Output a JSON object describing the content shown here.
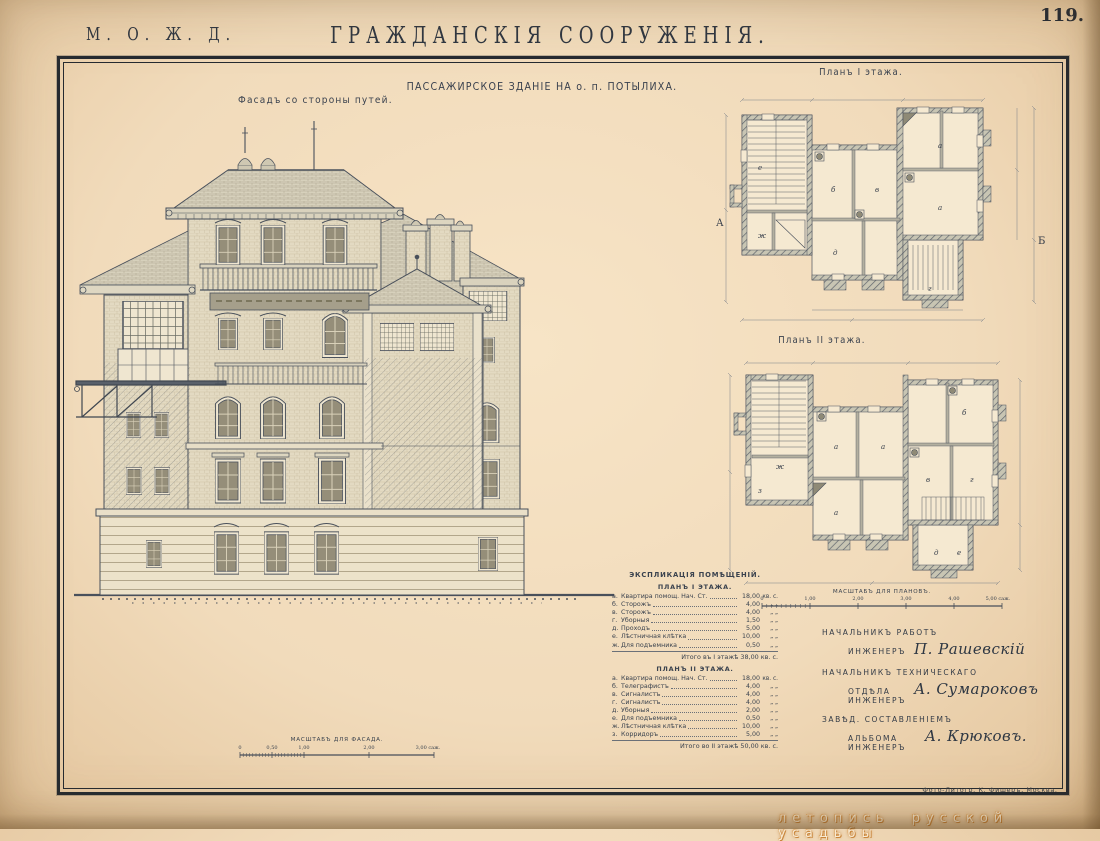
{
  "page": {
    "org": "М. О. Ж. Д.",
    "title": "ГРАЖДАНСКІЯ СООРУЖЕНІЯ.",
    "number": "119.",
    "credit": "Фото-Литогр. К. Фишеръ, Москва.",
    "watermark": "летопись русской усадьбы"
  },
  "plate": {
    "caption": "ПАССАЖИРСКОЕ ЗДАНІЕ НА о. п. ПОТЫЛИХА.",
    "facade_label": "Фасадъ со стороны путей.",
    "plan1_label": "Планъ I этажа.",
    "plan2_label": "Планъ II этажа.",
    "facade_scale": {
      "label": "МАСШТАБЪ ДЛЯ ФАСАДА.",
      "ticks": [
        "0",
        "0,50",
        "1,00",
        "2,00",
        "3,00 саж."
      ]
    },
    "plans_scale": {
      "label": "МАСШТАБЪ ДЛЯ ПЛАНОВЪ.",
      "ticks": [
        "0",
        "1,00",
        "2,00",
        "3,00",
        "4,00",
        "5,00 саж."
      ]
    }
  },
  "plan1": {
    "rooms": [
      "а",
      "б",
      "в",
      "г",
      "д",
      "е",
      "ж"
    ],
    "markers": {
      "left": "А",
      "right": "Б"
    }
  },
  "plan2": {
    "rooms": [
      "а",
      "б",
      "в",
      "г",
      "д",
      "е",
      "ж",
      "з"
    ]
  },
  "explication": {
    "header": "ЭКСПЛИКАЦІЯ ПОМѢЩЕНІЙ.",
    "floor1": {
      "title": "ПЛАНЪ I ЭТАЖА.",
      "items": [
        {
          "letter": "а.",
          "name": "Квартира помощ. Нач. Ст.",
          "value": "18,00",
          "unit": "кв. с."
        },
        {
          "letter": "б.",
          "name": "Сторожъ",
          "value": "4,00",
          "unit": "„ „"
        },
        {
          "letter": "в.",
          "name": "Сторожъ",
          "value": "4,00",
          "unit": "„ „"
        },
        {
          "letter": "г.",
          "name": "Уборныя",
          "value": "1,50",
          "unit": "„ „"
        },
        {
          "letter": "д.",
          "name": "Проходъ",
          "value": "5,00",
          "unit": "„ „"
        },
        {
          "letter": "е.",
          "name": "Лѣстничная клѣтка",
          "value": "10,00",
          "unit": "„ „"
        },
        {
          "letter": "ж.",
          "name": "Для подъемника",
          "value": "0,50",
          "unit": "„ „"
        }
      ],
      "total": "Итого въ I этажѣ 38,00 кв. с."
    },
    "floor2": {
      "title": "ПЛАНЪ II ЭТАЖА.",
      "items": [
        {
          "letter": "а.",
          "name": "Квартира помощ. Нач. Ст.",
          "value": "18,00",
          "unit": "кв. с."
        },
        {
          "letter": "б.",
          "name": "Телеграфистъ",
          "value": "4,00",
          "unit": "„ „"
        },
        {
          "letter": "в.",
          "name": "Сигналистъ",
          "value": "4,00",
          "unit": "„ „"
        },
        {
          "letter": "г.",
          "name": "Сигналистъ",
          "value": "4,00",
          "unit": "„ „"
        },
        {
          "letter": "д.",
          "name": "Уборныя",
          "value": "2,00",
          "unit": "„ „"
        },
        {
          "letter": "е.",
          "name": "Для подъемника",
          "value": "0,50",
          "unit": "„ „"
        },
        {
          "letter": "ж.",
          "name": "Лѣстничная клѣтка",
          "value": "10,00",
          "unit": "„ „"
        },
        {
          "letter": "з.",
          "name": "Корридоръ",
          "value": "5,00",
          "unit": "„ „"
        }
      ],
      "total": "Итого во II этажѣ 50,00 кв. с."
    }
  },
  "signatures": {
    "role1a": "НАЧАЛЬНИКЪ РАБОТЪ",
    "role1b": "ИНЖЕНЕРЪ",
    "name1": "П. Рашевскій",
    "role2a": "НАЧАЛЬНИКЪ ТЕХНИЧЕСКАГО",
    "role2b": "ОТДѢЛА ИНЖЕНЕРЪ",
    "name2": "А. Сумароковъ",
    "role3a": "ЗАВѢД. СОСТАВЛЕНІЕМЪ",
    "role3b": "АЛЬБОМА ИНЖЕНЕРЪ",
    "name3": "А. Крюковъ."
  },
  "colors": {
    "paper": "#f2ddbe",
    "ink": "#3c434f",
    "frame": "#262b31",
    "watermark_glow": "#c9853b"
  }
}
